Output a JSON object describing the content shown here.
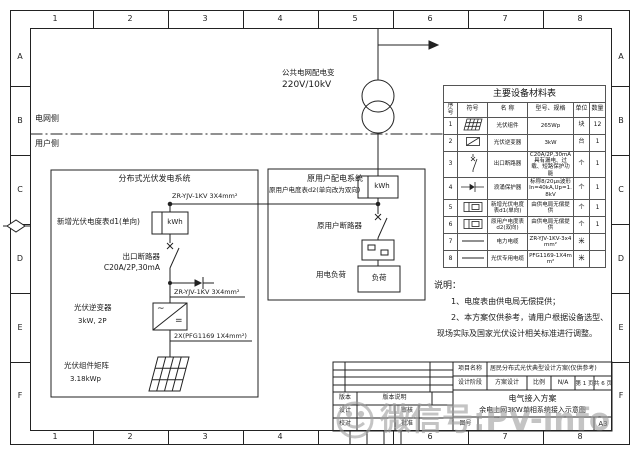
{
  "frame": {
    "cols": [
      "1",
      "2",
      "3",
      "4",
      "5",
      "6",
      "7",
      "8"
    ],
    "rows": [
      "A",
      "B",
      "C",
      "D",
      "E",
      "F"
    ]
  },
  "grid_source": {
    "name": "公共电网配电变",
    "voltage": "220V/10kV",
    "grid_side": "电网侧",
    "user_side": "用户侧"
  },
  "pv_system": {
    "title": "分布式光伏发电系统",
    "cable1": "ZR-YJV-1KV 3X4mm²",
    "meter_label": "新增光伏电度表d1(单向)",
    "meter_unit": "kWh",
    "breaker_line1": "出口断路器",
    "breaker_line2": "C20A/2P,30mA",
    "cable2": "ZR-YJV-1KV 3X4mm²",
    "inverter_label": "光伏逆变器",
    "inverter_spec": "3kW, 2P",
    "inverter_ac": "~",
    "inverter_dc": "=",
    "cable3": "2X(PFG1169 1X4mm²)",
    "array_label": "光伏组件矩阵",
    "array_spec": "3.18kWp"
  },
  "user_system": {
    "title": "原用户配电系统",
    "subtitle": "原用户电度表d2(单向改为双向)",
    "meter_unit": "kWh",
    "breaker_label": "原用户断路器",
    "load_label": "用电负荷",
    "load_box_text": "负荷"
  },
  "equipment_table": {
    "title": "主要设备材料表",
    "headers": [
      "序号",
      "符号",
      "名 称",
      "型号、规格",
      "单位",
      "数量"
    ],
    "rows": [
      {
        "no": "1",
        "name": "光伏组件",
        "spec": "265Wp",
        "unit": "块",
        "qty": "12"
      },
      {
        "no": "2",
        "name": "光伏逆变器",
        "spec": "3kW",
        "unit": "台",
        "qty": "1"
      },
      {
        "no": "3",
        "name": "出口断路器",
        "spec": "C20A/2P,30mA 具有漏电、过载、短路保护功能",
        "unit": "个",
        "qty": "1"
      },
      {
        "no": "4",
        "name": "浪涌保护器",
        "spec": "标称8/20μs波形 In=40kA,Up=1.8kV",
        "unit": "个",
        "qty": "1"
      },
      {
        "no": "5",
        "name": "新增光伏电度表d1(单向)",
        "spec": "由供电局无偿提供",
        "unit": "个",
        "qty": "1"
      },
      {
        "no": "6",
        "name": "原用户电度表d2(双向)",
        "spec": "由供电局无偿提供",
        "unit": "个",
        "qty": "1"
      },
      {
        "no": "7",
        "name": "电力电缆",
        "spec": "ZR-YJV-1KV-3x4mm²",
        "unit": "米",
        "qty": ""
      },
      {
        "no": "8",
        "name": "光伏专用电缆",
        "spec": "PFG1169-1X4mm²",
        "unit": "米",
        "qty": ""
      }
    ]
  },
  "notes": {
    "title": "说明：",
    "line1": "1、电度表由供电局无偿提供；",
    "line2": "2、本方案仅供参考，请用户根据设备选型、",
    "line3": "现场实际及国家光伏设计相关标准进行调整。"
  },
  "title_block": {
    "project_label": "项目名称",
    "project_value": "居民分布式光伏典型设计方案(仅供参考)",
    "stage_label": "设计阶段",
    "stage_value": "方案设计",
    "scale_label": "比例",
    "scale_value": "N/A",
    "page": "第 1 页",
    "pages": "共 6 页",
    "drawing_title1": "电气接入方案",
    "drawing_title2": "余电上网3KW单相系统接入示意图",
    "version_label": "版本",
    "version_desc_label": "版本说明",
    "design_label": "设计",
    "review_label": "审核",
    "check_label": "校对",
    "approve_label": "批准",
    "drawing_no_label": "图号",
    "sheet_size": "A3"
  },
  "watermark": {
    "text": "微信号:PV-info"
  }
}
